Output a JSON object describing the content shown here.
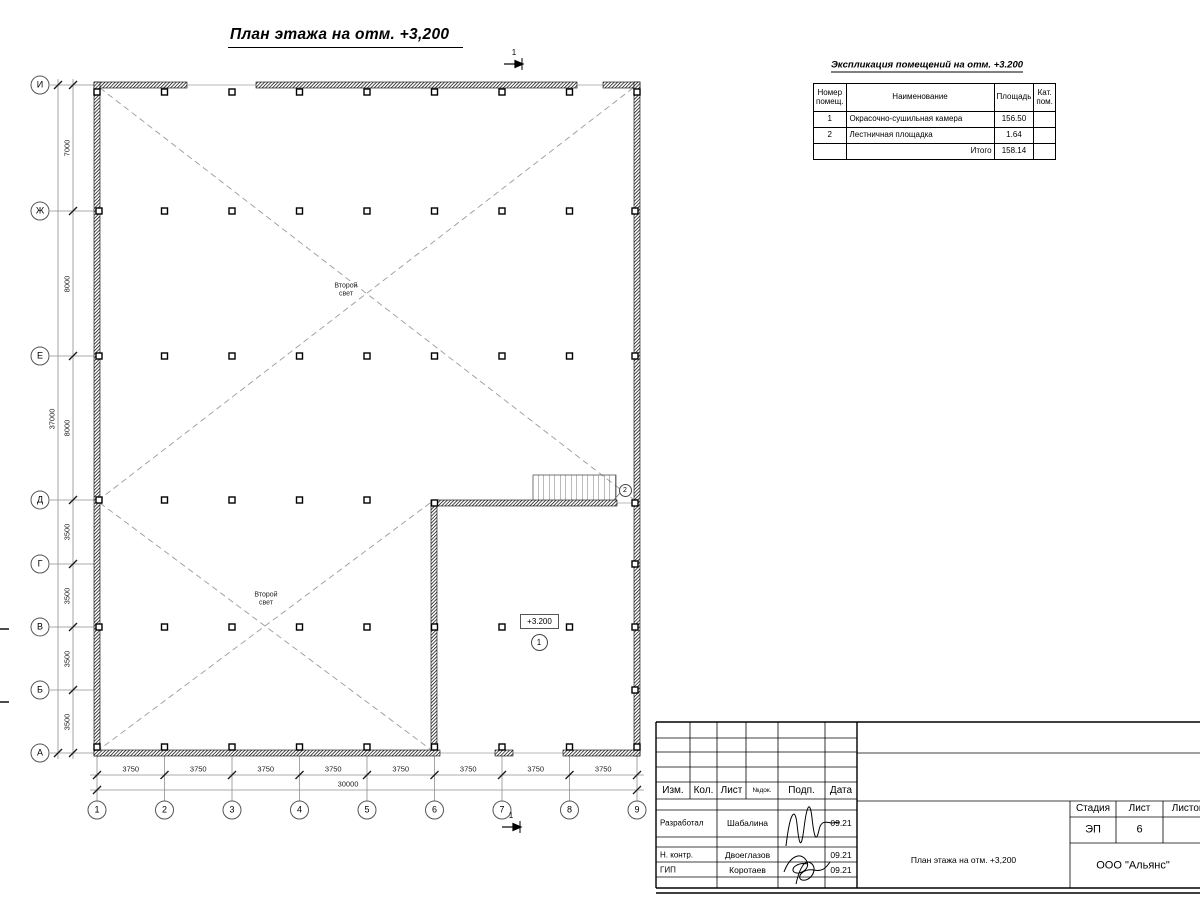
{
  "drawing_title": "План этажа на отм. +3,200",
  "section_mark": "1",
  "plan": {
    "bottom_axes": [
      "1",
      "2",
      "3",
      "4",
      "5",
      "6",
      "7",
      "8",
      "9"
    ],
    "left_axes": [
      "И",
      "Ж",
      "Е",
      "Д",
      "Г",
      "В",
      "Б",
      "А"
    ],
    "bottom_dims": [
      "3750",
      "3750",
      "3750",
      "3750",
      "3750",
      "3750",
      "3750",
      "3750"
    ],
    "bottom_total": "30000",
    "left_dims": [
      "7000",
      "8000",
      "8000",
      "3500",
      "3500",
      "3500",
      "3500"
    ],
    "left_total": "37000",
    "void_label": {
      "line1": "Второй",
      "line2": "свет"
    },
    "elevation_label": "+3.200",
    "room1_number": "1",
    "room2_number": "2"
  },
  "expl_table": {
    "title": "Экспликация помещений на отм. +3.200",
    "col_num": "Номер помещ.",
    "col_name": "Наименование",
    "col_area": "Площадь",
    "col_cat": "Кат. пом.",
    "rows": [
      {
        "num": "1",
        "name": "Окрасочно-сушильная камера",
        "area": "156.50",
        "cat": ""
      },
      {
        "num": "2",
        "name": "Лестничная площадка",
        "area": "1.64",
        "cat": ""
      }
    ],
    "total_label": "Итого",
    "total_value": "158.14"
  },
  "title_block": {
    "col_izm": "Изм.",
    "col_kol": "Кол.",
    "col_list": "Лист",
    "col_ndok": "№док.",
    "col_podp": "Подп.",
    "col_data": "Дата",
    "rows": [
      {
        "role": "Разработал",
        "name": "Шабалина",
        "date": "09.21"
      },
      {
        "role": "Н. контр.",
        "name": "Двоеглазов",
        "date": "09.21"
      },
      {
        "role": "ГИП",
        "name": "Коротаев",
        "date": "09.21"
      }
    ],
    "stage_label": "Стадия",
    "sheet_label": "Лист",
    "sheets_label": "Листов",
    "stage_value": "ЭП",
    "sheet_value": "6",
    "doc_name": "План этажа на отм. +3,200",
    "org_name": "ООО \"Альянс\""
  }
}
